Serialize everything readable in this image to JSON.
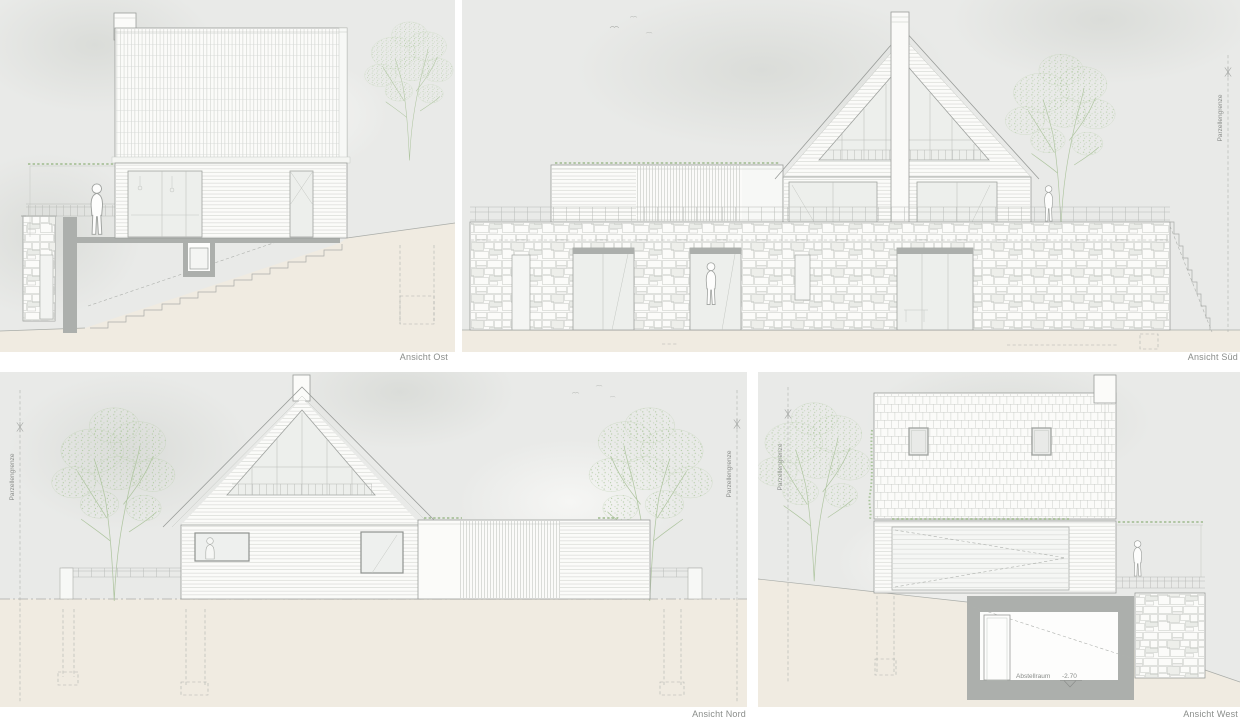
{
  "document": {
    "type": "architectural-elevations",
    "language": "de"
  },
  "panels": {
    "ost": {
      "title": "Ansicht Ost"
    },
    "sued": {
      "title": "Ansicht Süd",
      "boundary_label": "Parzellengrenze"
    },
    "nord": {
      "title": "Ansicht Nord",
      "boundary_label_left": "Parzellengrenze",
      "boundary_label_right": "Parzellengrenze"
    },
    "west": {
      "title": "Ansicht West",
      "boundary_label": "Parzellengrenze",
      "basement": {
        "room_label": "Abstellraum",
        "level": "-2.70"
      }
    }
  },
  "colors": {
    "page": "#FFFFFF",
    "sky": "#E9EAE8",
    "ground": "#F0EBE1",
    "outline": "#9A9D9A",
    "texture_line": "#C4C7C2",
    "section_cut_fill": "#ACAFAC",
    "vegetation": "#ADC7A0",
    "sedum_green": "#9DBA8C",
    "label_text": "#8A8D8A"
  }
}
